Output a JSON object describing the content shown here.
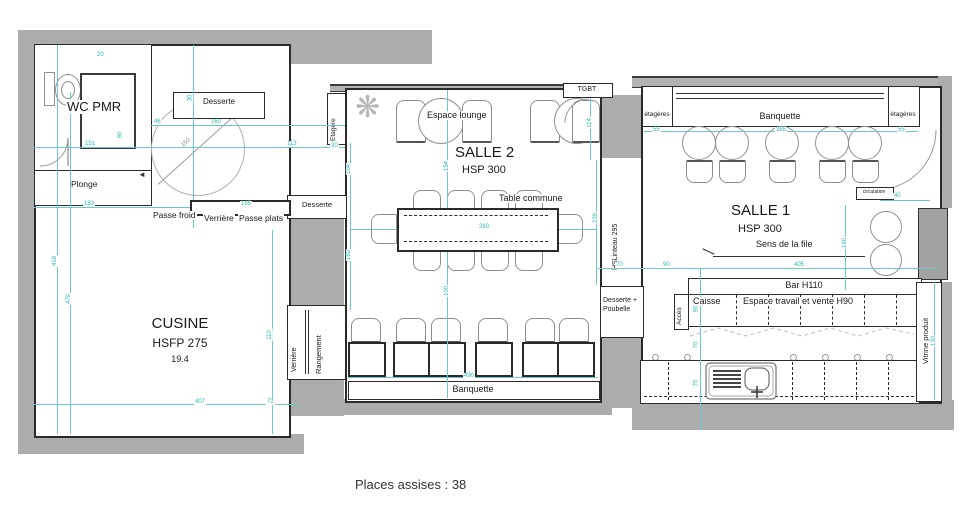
{
  "plan": {
    "footer": "Places assises : 38",
    "rooms": {
      "wc": {
        "name": "WC PMR"
      },
      "plonge": {
        "label": "Plonge"
      },
      "cuisine": {
        "name": "CUSINE",
        "height": "HSFP 275",
        "area": "19.4"
      },
      "salle2": {
        "name": "SALLE 2",
        "height": "HSP 300"
      },
      "salle1": {
        "name": "SALLE 1",
        "height": "HSP 300"
      }
    },
    "labels": {
      "desserte_top": "Desserte",
      "desserte_mid": "Desserte",
      "passe_froid": "Passe froid",
      "passe_verriere": "Verrière",
      "passe_plats": "Passe plats",
      "verriere_vertical": "Verrière",
      "rangement": "Rangement",
      "etagere": "Etagère",
      "espace_lounge": "Espace lounge",
      "table_commune": "Table commune",
      "banquette_salle2": "Banquette",
      "tgbt": "TGBT",
      "hs_linteau": "HSLinteau 295",
      "desserte_poubelle": "Desserte + Poubelle",
      "etageres_left": "étagères",
      "etageres_right": "étagères",
      "banquette_salle1": "Banquette",
      "sens_de_la_file": "Sens de la file",
      "circulation": "circulation",
      "bar": "Bar H110",
      "caisse": "Caisse",
      "espace_travail": "Espace travail et vente H90",
      "acces": "Accès",
      "vitrine": "Vitrine produit"
    },
    "icons": {
      "plant_glyph": "❋",
      "door_arrow": "◄"
    },
    "dims": [
      {
        "v": "20"
      },
      {
        "v": "30"
      },
      {
        "v": "46"
      },
      {
        "v": "160"
      },
      {
        "v": "151"
      },
      {
        "v": "113"
      },
      {
        "v": "90"
      },
      {
        "v": "30"
      },
      {
        "v": "104"
      },
      {
        "v": "160"
      },
      {
        "v": "183"
      },
      {
        "v": "185"
      },
      {
        "v": "418"
      },
      {
        "v": "479"
      },
      {
        "v": "110"
      },
      {
        "v": "407"
      },
      {
        "v": "72"
      },
      {
        "v": "150"
      },
      {
        "v": "154"
      },
      {
        "v": "260"
      },
      {
        "v": "100"
      },
      {
        "v": "490"
      },
      {
        "v": "114"
      },
      {
        "v": "239"
      },
      {
        "v": "55"
      },
      {
        "v": "385"
      },
      {
        "v": "55"
      },
      {
        "v": "70"
      },
      {
        "v": "90"
      },
      {
        "v": "405"
      },
      {
        "v": "40"
      },
      {
        "v": "190"
      },
      {
        "v": "90"
      },
      {
        "v": "70"
      },
      {
        "v": "70"
      },
      {
        "v": "130"
      }
    ],
    "colors": {
      "wall": "#acacac",
      "dimension": "#2eb5b7",
      "line": "#2a2a2a"
    }
  }
}
